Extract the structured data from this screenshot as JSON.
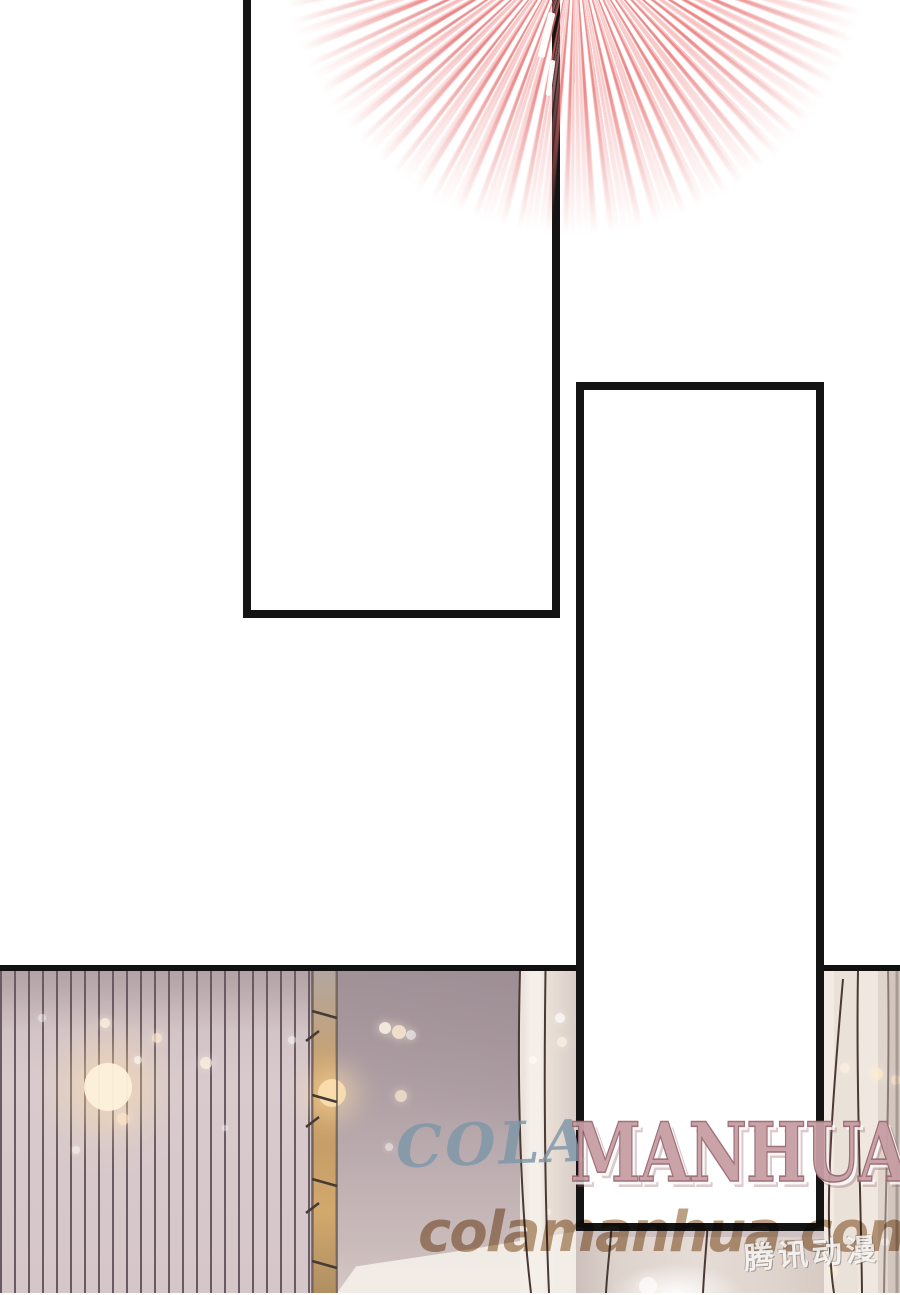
{
  "page": {
    "kind": "manhua comic page",
    "background": "#ffffff",
    "panel_border_color": "#141414"
  },
  "burst": {
    "color_strong": "#e86e6e",
    "color_soft": "#f4a0a0"
  },
  "watermark": {
    "cola_text": "COLA",
    "cola_color": "#7e96a8",
    "manhua_text": "MANHUA",
    "manhua_color": "#c79fa4",
    "site_text": "colamanhua.com",
    "site_color": "#b08f6d",
    "logo_text": "腾讯动漫"
  },
  "scene": {
    "stripe_wall_base": "#d8cacd",
    "stripe_line_color": "#695b61",
    "ladder_color": "#c9a26b",
    "wall_color": "#b0a1a6",
    "curtain_color": "#ece3db",
    "sparkles": [
      {
        "x": 108,
        "y": 1087,
        "r": 24,
        "c": "#fff3dc",
        "o": 0.95,
        "halo": 1
      },
      {
        "x": 332,
        "y": 1093,
        "r": 14,
        "c": "#ffe3b4",
        "o": 0.9,
        "halo": 1
      },
      {
        "x": 105,
        "y": 1023,
        "r": 5,
        "c": "#fff2dd",
        "o": 0.8
      },
      {
        "x": 157,
        "y": 1038,
        "r": 5,
        "c": "#ffe9cf",
        "o": 0.7
      },
      {
        "x": 138,
        "y": 1060,
        "r": 4,
        "c": "#ffffff",
        "o": 0.6
      },
      {
        "x": 206,
        "y": 1063,
        "r": 6,
        "c": "#fff4e0",
        "o": 0.75
      },
      {
        "x": 292,
        "y": 1040,
        "r": 4,
        "c": "#ffffff",
        "o": 0.5
      },
      {
        "x": 123,
        "y": 1119,
        "r": 6,
        "c": "#ffe6c6",
        "o": 0.7
      },
      {
        "x": 76,
        "y": 1150,
        "r": 4,
        "c": "#ffffff",
        "o": 0.5
      },
      {
        "x": 42,
        "y": 1018,
        "r": 4,
        "c": "#ffffff",
        "o": 0.45
      },
      {
        "x": 225,
        "y": 1128,
        "r": 3,
        "c": "#ffffff",
        "o": 0.45
      },
      {
        "x": 385,
        "y": 1028,
        "r": 6,
        "c": "#fff6e6",
        "o": 0.85
      },
      {
        "x": 399,
        "y": 1032,
        "r": 7,
        "c": "#ffefd5",
        "o": 0.8
      },
      {
        "x": 411,
        "y": 1035,
        "r": 5,
        "c": "#ffffff",
        "o": 0.6
      },
      {
        "x": 401,
        "y": 1096,
        "r": 6,
        "c": "#ffeed2",
        "o": 0.7
      },
      {
        "x": 389,
        "y": 1147,
        "r": 4,
        "c": "#ffffff",
        "o": 0.5
      },
      {
        "x": 560,
        "y": 1018,
        "r": 5,
        "c": "#ffffff",
        "o": 0.7
      },
      {
        "x": 562,
        "y": 1042,
        "r": 5,
        "c": "#fff8ea",
        "o": 0.65
      },
      {
        "x": 533,
        "y": 1060,
        "r": 4,
        "c": "#ffffff",
        "o": 0.55
      },
      {
        "x": 845,
        "y": 1068,
        "r": 5,
        "c": "#fff3de",
        "o": 0.7
      },
      {
        "x": 877,
        "y": 1074,
        "r": 6,
        "c": "#ffeccd",
        "o": 0.75
      },
      {
        "x": 896,
        "y": 1080,
        "r": 5,
        "c": "#ffe9c9",
        "o": 0.65
      },
      {
        "x": 857,
        "y": 1129,
        "r": 4,
        "c": "#ffffff",
        "o": 0.5
      },
      {
        "x": 885,
        "y": 1242,
        "r": 4,
        "c": "#ffffff",
        "o": 0.5
      },
      {
        "x": 833,
        "y": 1272,
        "r": 5,
        "c": "#fff0d8",
        "o": 0.6
      },
      {
        "x": 548,
        "y": 1212,
        "r": 3,
        "c": "#ffffff",
        "o": 0.5
      },
      {
        "x": 648,
        "y": 1286,
        "r": 9,
        "c": "#ffffff",
        "o": 0.7
      }
    ]
  }
}
